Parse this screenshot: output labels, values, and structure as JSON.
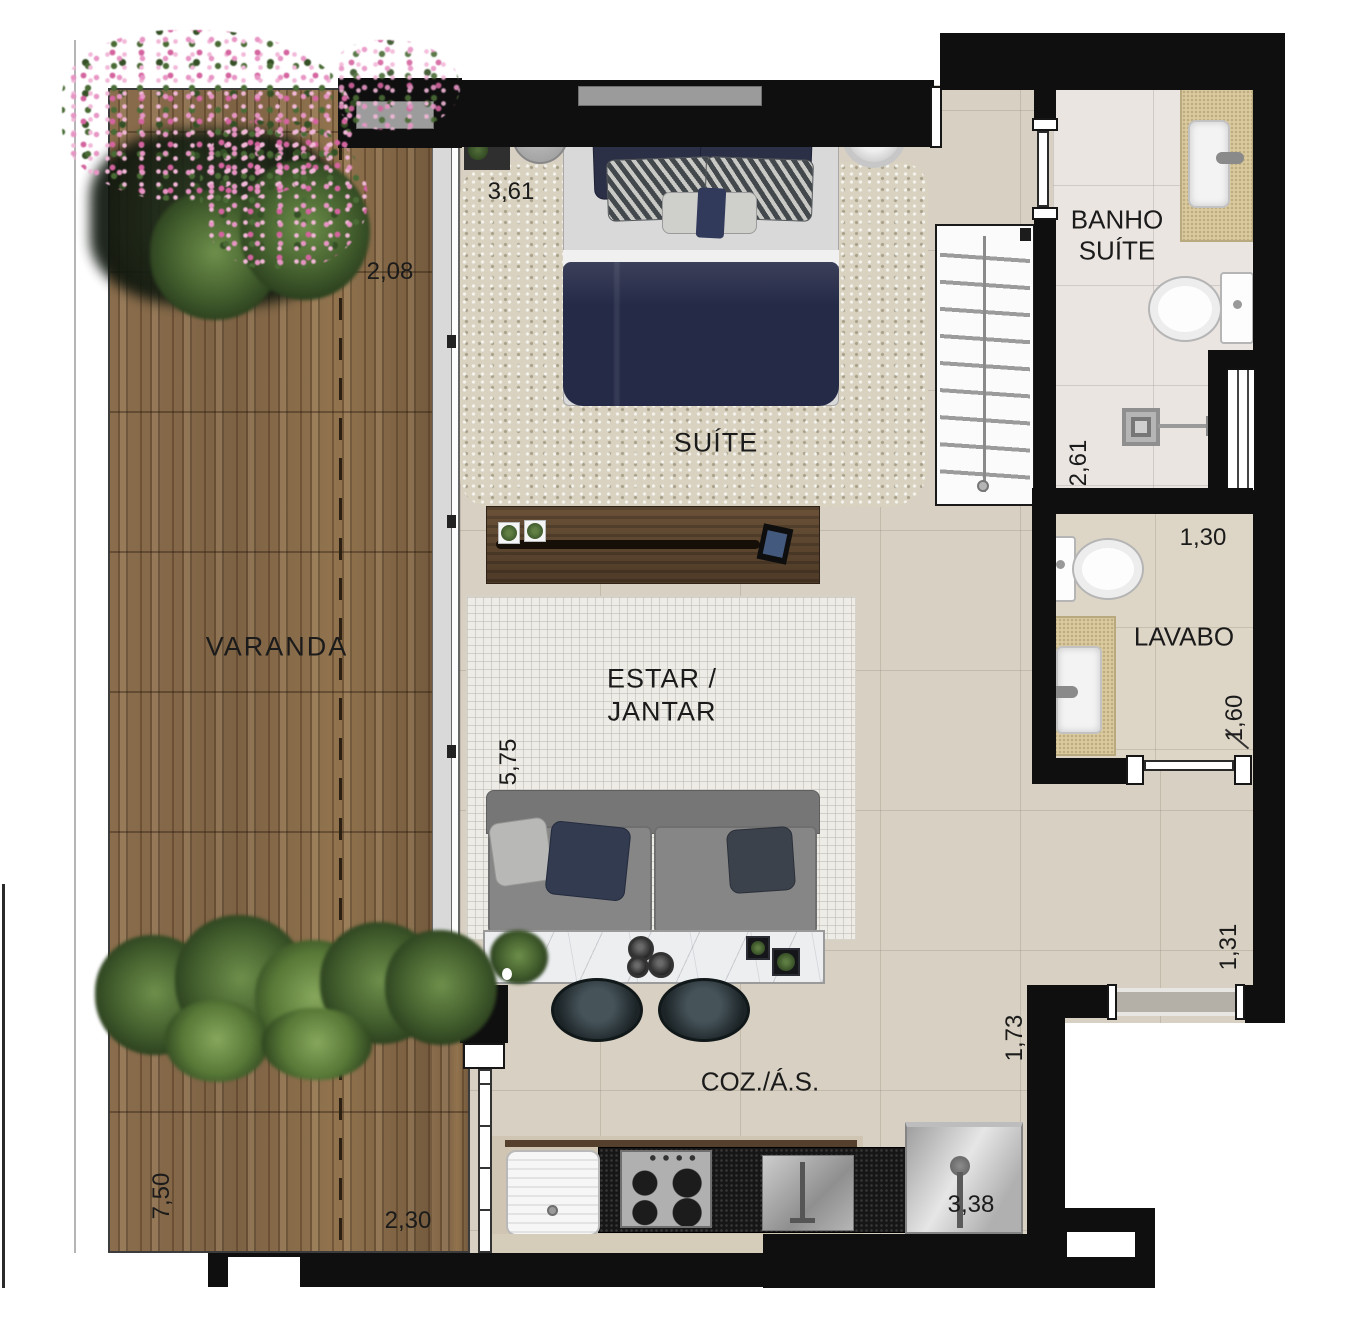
{
  "rooms": {
    "varanda": {
      "label": "VARANDA",
      "length": "7,50",
      "width": "2,08",
      "inner_width": "2,30"
    },
    "suite": {
      "label": "SUÍTE",
      "width": "3,61"
    },
    "banho_suite": {
      "label_line1": "BANHO",
      "label_line2": "SUÍTE",
      "depth": "2,61"
    },
    "lavabo": {
      "label": "LAVABO",
      "width": "1,30",
      "depth": "1,60"
    },
    "estar_jantar": {
      "label_line1": "ESTAR /",
      "label_line2": "JANTAR",
      "depth": "5,75"
    },
    "cozinha": {
      "label": "COZ./Á.S.",
      "depth": "1,73",
      "width": "3,38"
    },
    "hall": {
      "width": "1,31"
    }
  },
  "colors": {
    "wall": "#0f0f0f",
    "deck_wood": "#85694a",
    "interior_floor": "#d8d0c2",
    "banho_floor": "#ebe5e2",
    "bed_navy": "#252a47",
    "plant_green": "#46622f",
    "flower_pink": "#d4649f"
  }
}
